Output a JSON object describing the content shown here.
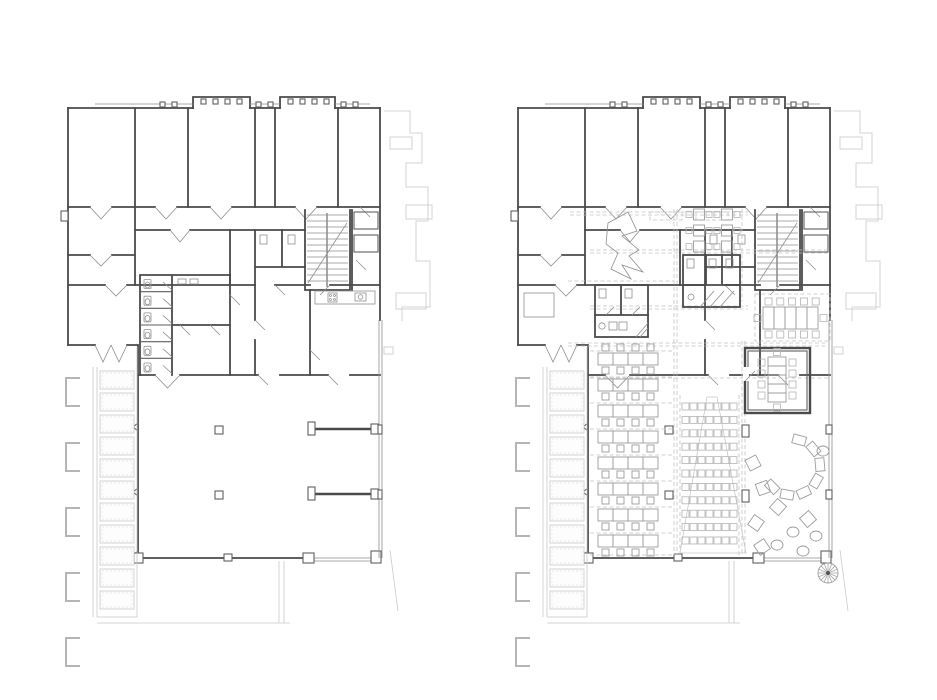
{
  "meta": {
    "title": "Two architectural floor plans: existing state (left) and furnished proposal (right)",
    "background": "#ffffff"
  },
  "colors": {
    "wall": "#4a4a4a",
    "wall_medium": "#5f5f5f",
    "thin": "#8f8f8f",
    "faint": "#c9c9c9",
    "dashed": "#c3c3c3",
    "furniture": "#9c9c9c",
    "lightwell_fill": "#fdfdfd"
  },
  "plans": [
    {
      "key": "left",
      "name": "existing-floor-plan",
      "origin": {
        "x": 60,
        "y": 95
      }
    },
    {
      "key": "right",
      "name": "furnished-floor-plan",
      "origin": {
        "x": 510,
        "y": 95
      }
    }
  ],
  "shared": {
    "stair_treads": {
      "count": 12,
      "x1": 247,
      "x2": 288,
      "y_start": 120,
      "pitch": 6
    },
    "lightwell_panels": {
      "count": 11,
      "x": 40,
      "y_start": 276,
      "width": 34,
      "height": 18,
      "gap": 4
    },
    "context_brackets": {
      "count": 5,
      "x": 6,
      "y_start": 283,
      "pitch": 65,
      "width": 14,
      "height": 28
    }
  },
  "left_plan": {
    "wc_stalls": {
      "count": 6,
      "x": 80,
      "y_start": 180,
      "pitch": 16.7
    }
  },
  "furniture": {
    "desk_rows": {
      "rows": 8,
      "desks_per_row": 4,
      "x": 88,
      "y_start": 258,
      "row_pitch": 26,
      "desk_w": 15,
      "desk_h": 12,
      "chair": 7
    },
    "auditorium": {
      "rows": 11,
      "seats_per_row": 7,
      "x": 172,
      "y_start": 308,
      "row_pitch": 13.4,
      "seat": 7,
      "seat_pitch": 8
    },
    "cafe_tables": {
      "rows": 3,
      "sets_per_row": 2,
      "x": 176,
      "y_start": 114,
      "row_pitch": 16,
      "set_pitch": 28,
      "table": 11,
      "chair": 6
    },
    "meeting_table_open": {
      "x": 253,
      "y": 212,
      "segments": 5,
      "seg_w": 11,
      "seg_h": 22,
      "chairs_top": 5,
      "chairs_bottom": 5,
      "chairs_left": 1,
      "chairs_right": 1
    },
    "meeting_room_table": {
      "x": 258,
      "y": 262,
      "segments": 5,
      "seg_w": 18,
      "seg_h": 9,
      "chairs_left": 4,
      "chairs_right": 4,
      "chairs_top": 1,
      "chairs_bottom": 1
    },
    "lounge_arc": {
      "cx": 282,
      "cy": 372,
      "radius": 28,
      "seat_w": 13,
      "seat_h": 9,
      "angles_deg": [
        -75,
        -40,
        -5,
        30,
        65,
        100,
        135
      ]
    },
    "poufs": {
      "diamonds": [
        [
          246,
          428
        ],
        [
          268,
          412
        ],
        [
          298,
          424
        ],
        [
          252,
          452
        ],
        [
          243,
          368
        ],
        [
          253,
          393
        ]
      ],
      "rounds": [
        [
          283,
          437
        ],
        [
          306,
          441
        ],
        [
          267,
          450
        ],
        [
          293,
          456
        ],
        [
          313,
          356
        ]
      ],
      "diamond_size": 12,
      "round_rx": 6,
      "round_ry": 5
    },
    "spiral_stair": {
      "cx": 318,
      "cy": 478,
      "radius": 10,
      "spokes": 16
    }
  }
}
